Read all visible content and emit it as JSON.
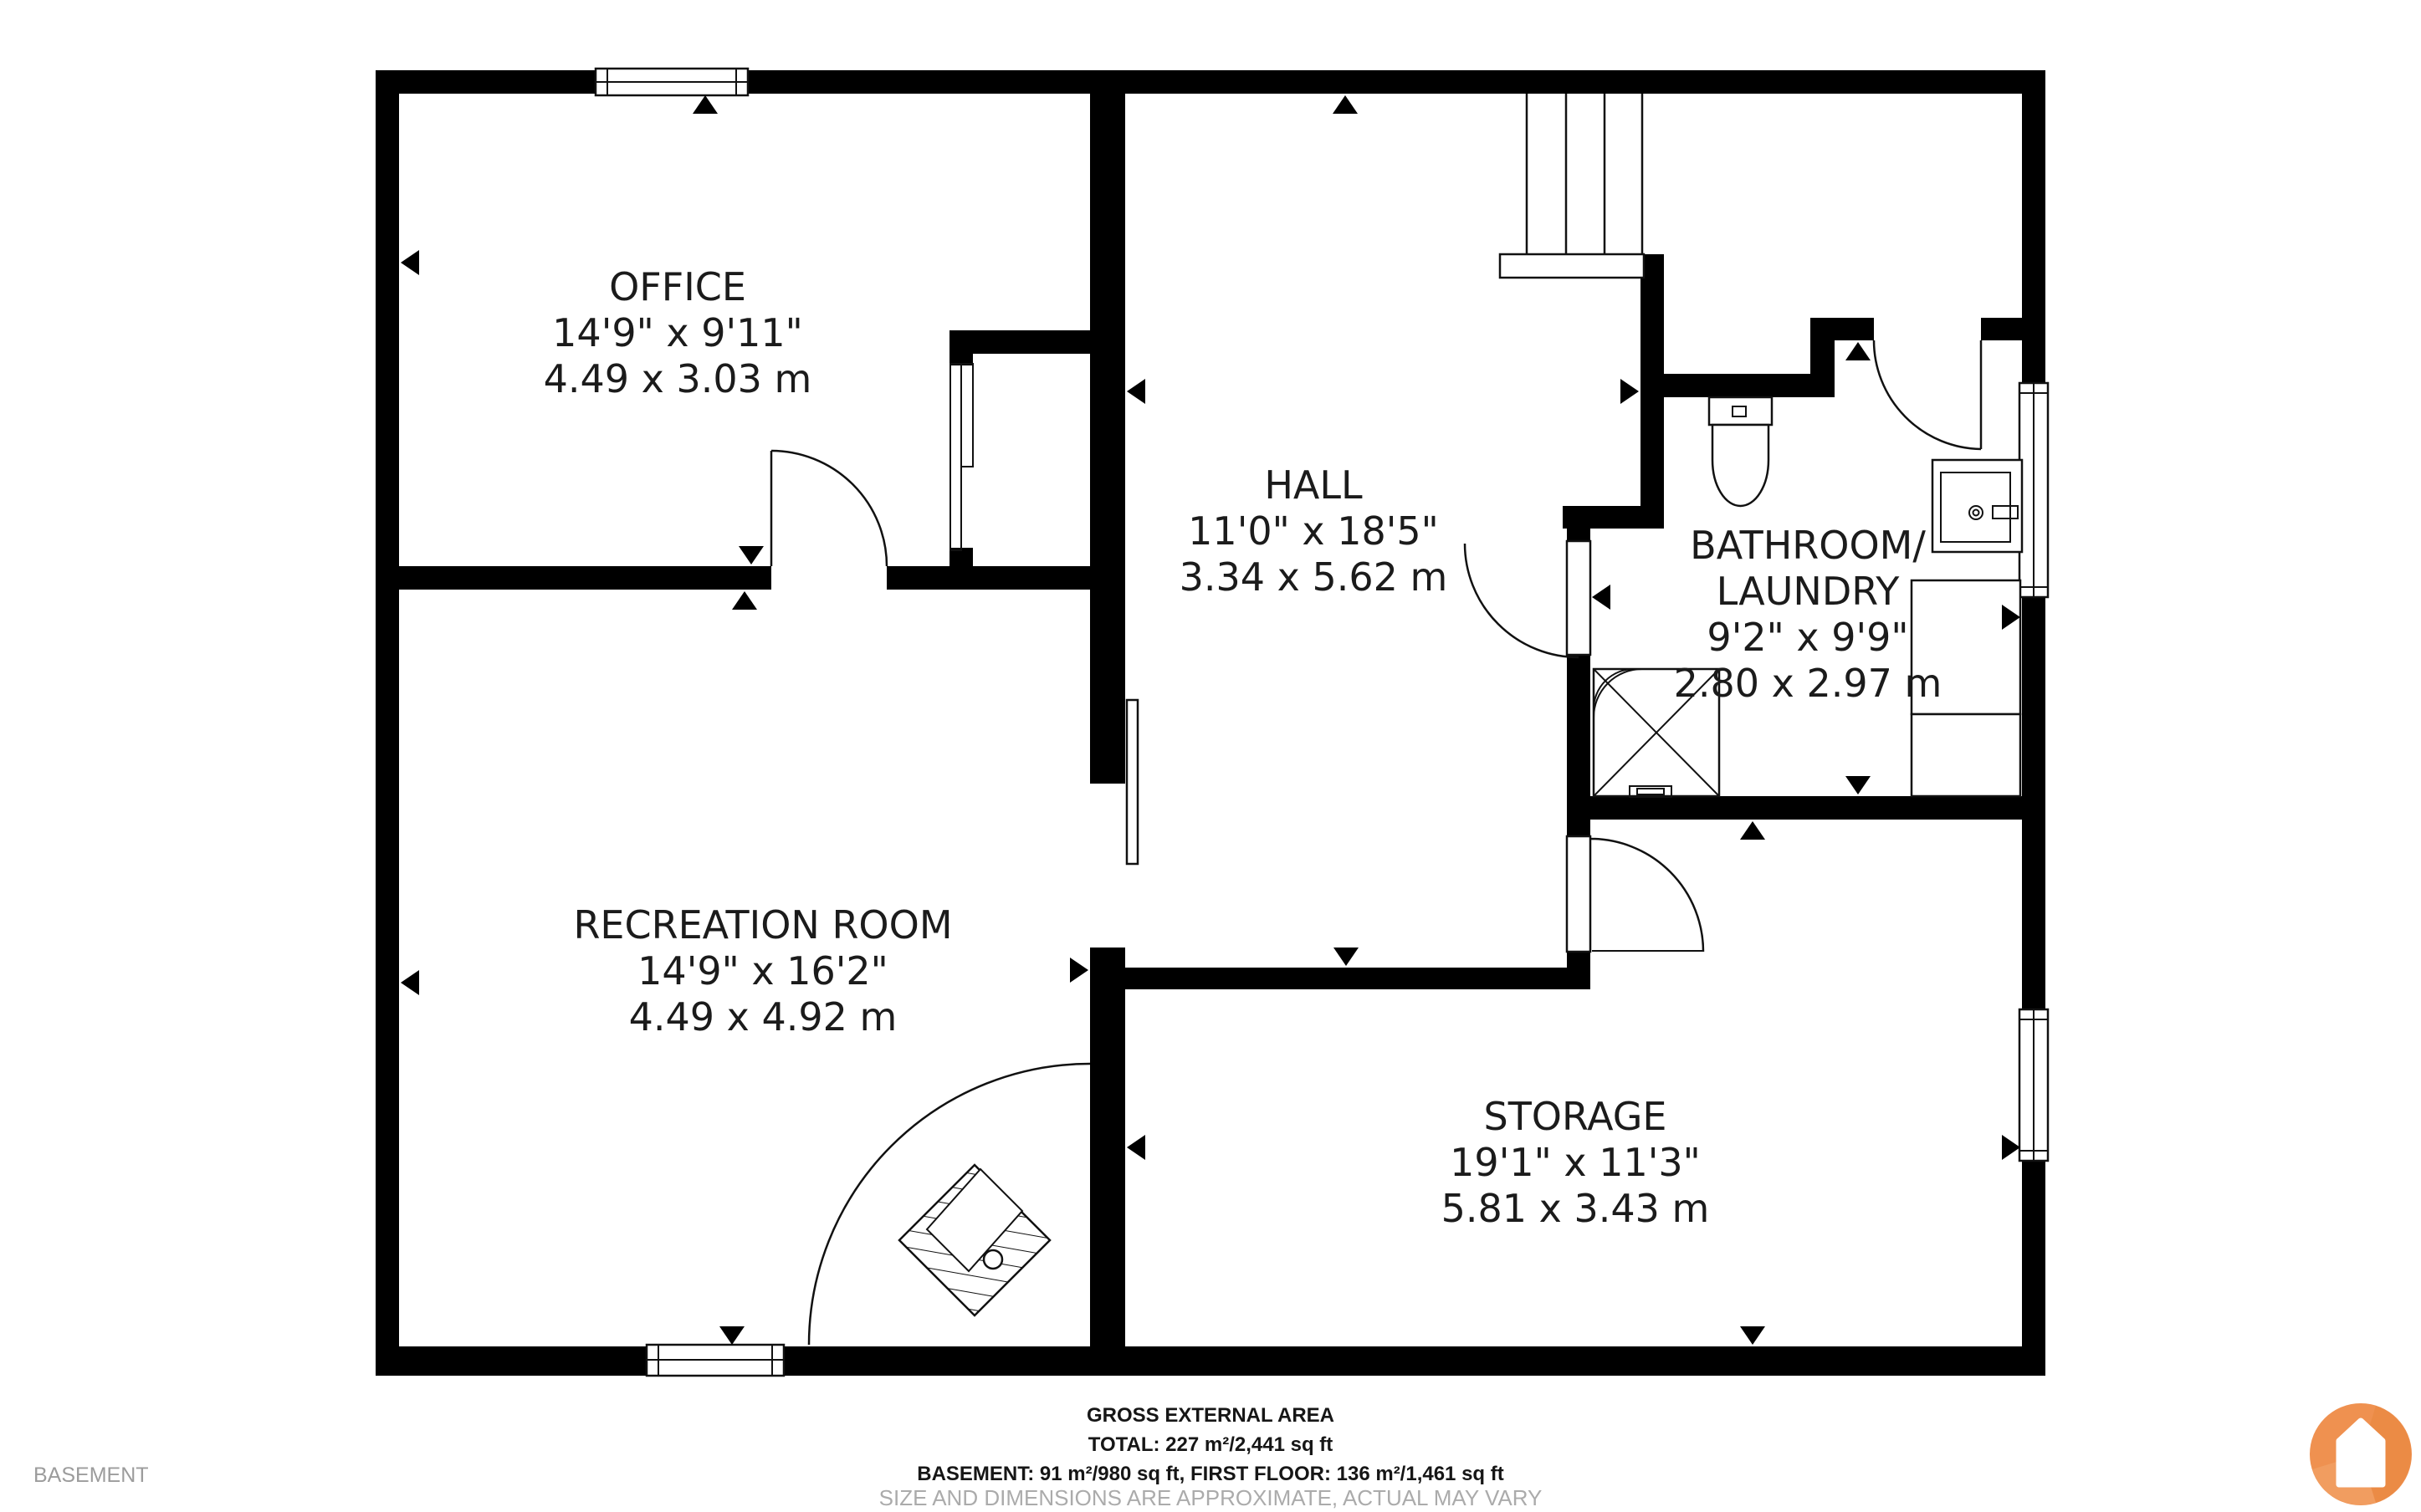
{
  "floor_label": "BASEMENT",
  "rooms": [
    {
      "id": "office",
      "lines": [
        "OFFICE",
        "14'9\" x 9'11\"",
        "4.49 x 3.03 m"
      ]
    },
    {
      "id": "hall",
      "lines": [
        "HALL",
        "11'0\" x 18'5\"",
        "3.34 x 5.62 m"
      ]
    },
    {
      "id": "bathroom",
      "lines": [
        "BATHROOM/",
        "LAUNDRY",
        "9'2\" x 9'9\"",
        "2.80 x 2.97 m"
      ]
    },
    {
      "id": "recreation",
      "lines": [
        "RECREATION ROOM",
        "14'9\" x 16'2\"",
        "4.49 x 4.92 m"
      ]
    },
    {
      "id": "storage",
      "lines": [
        "STORAGE",
        "19'1\" x 11'3\"",
        "5.81 x 3.43 m"
      ]
    }
  ],
  "footer": {
    "lines": [
      "GROSS EXTERNAL AREA",
      "TOTAL: 227 m²/2,441 sq ft",
      "BASEMENT: 91 m²/980 sq ft, FIRST FLOOR: 136 m²/1,461 sq ft",
      "SIZE AND DIMENSIONS ARE APPROXIMATE, ACTUAL MAY VARY"
    ]
  },
  "colors": {
    "wall": "#000000",
    "text": "#1b1b1b",
    "muted": "#ababab",
    "logo_orange": "#EF9150",
    "logo_orange_dark": "#E8873D",
    "logo_orange_light": "#F4AC73"
  },
  "icons": {
    "logo": "house-in-circle"
  }
}
